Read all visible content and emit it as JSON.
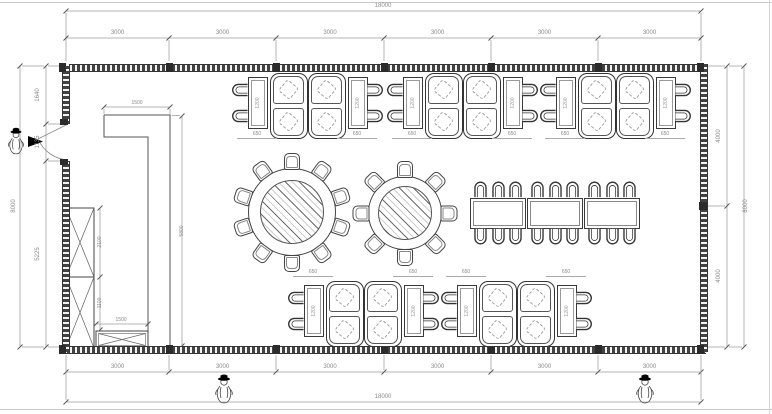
{
  "drawing": {
    "type": "restaurant-dining-hall-floor-plan"
  },
  "colors": {
    "wall": "#424242",
    "line": "#3a3a3a",
    "dim_line": "#999999",
    "dim_text": "#8a8a8a",
    "table_hatch": "#cfcfcf",
    "marker_black": "#000000",
    "frame": "#c9c9c9"
  },
  "dimensions": {
    "top": {
      "overall": "18000",
      "segments": [
        "3000",
        "3000",
        "3000",
        "3000",
        "3000",
        "3000"
      ]
    },
    "bottom": {
      "overall": "18000",
      "segments": [
        "3000",
        "3000",
        "3000",
        "3000",
        "3000",
        "3000"
      ]
    },
    "left": {
      "overall": "8000",
      "segments": [
        "1640",
        "1135",
        "5225"
      ]
    },
    "right": {
      "overall": "8000",
      "segments": [
        "4000",
        "4000"
      ]
    },
    "counter": {
      "top_width": "1500",
      "height": "5800"
    },
    "cabinets": {
      "upper_height": "2100",
      "lower_height": "1100",
      "bottom_width": "1500"
    },
    "booth": {
      "table_width": "650",
      "table_length": "1200"
    }
  },
  "furniture": {
    "top_booth_clusters": 3,
    "bottom_booth_clusters": 2,
    "booths_per_cluster": 2,
    "end_tables_per_cluster": 2,
    "chairs_per_end_table": 2,
    "round_tables": [
      {
        "id": "large",
        "seats": 10
      },
      {
        "id": "small",
        "seats": 8
      }
    ],
    "long_table_row": {
      "tables": 3,
      "chairs_per_side": 3
    },
    "tall_cabinets": 2,
    "low_cabinets": 1
  },
  "figures": {
    "entry_marker": "person-with-hat",
    "bottom_markers": [
      "person-with-hat",
      "person-with-hat"
    ]
  }
}
